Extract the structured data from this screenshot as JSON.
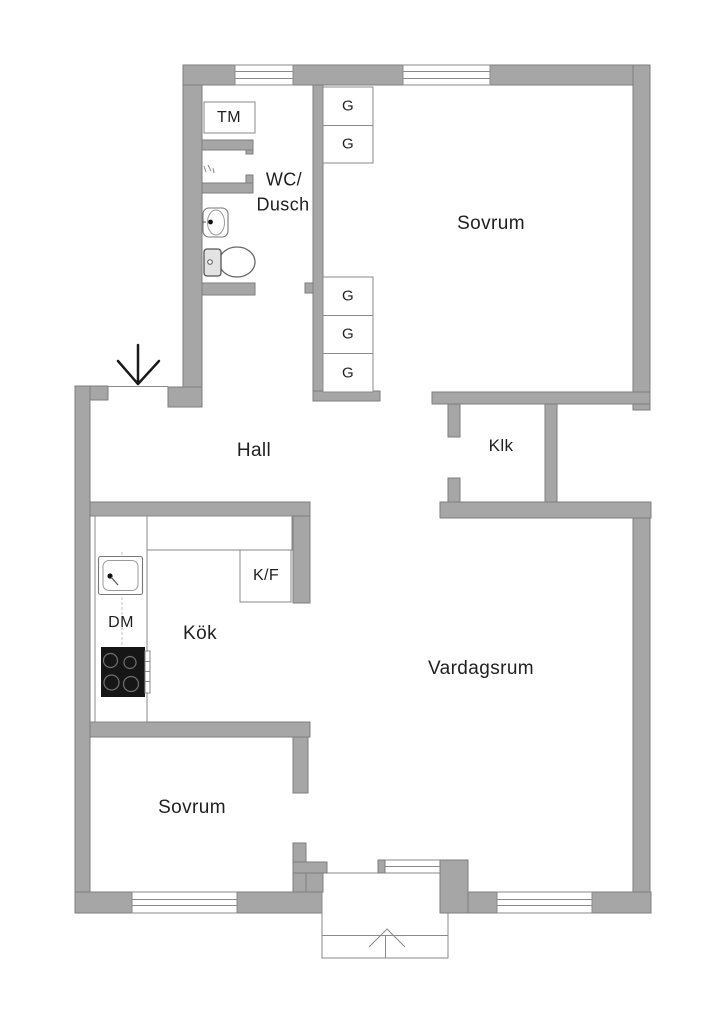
{
  "colors": {
    "background": "#ffffff",
    "wall": "#a6a6a6",
    "wall_outline": "#7e7e7e",
    "fixture_line": "#8a8a8a",
    "text": "#1f1f1f",
    "stove": "#161616"
  },
  "rooms": {
    "sovrum_top": "Sovrum",
    "hall": "Hall",
    "klk": "Klk",
    "kok": "Kök",
    "vardagsrum": "Vardagsrum",
    "sovrum_bottom": "Sovrum",
    "wc_dusch_line1": "WC/",
    "wc_dusch_line2": "Dusch"
  },
  "fixtures": {
    "washing_machine": "TM",
    "dishwasher": "DM",
    "fridge_freezer": "K/F",
    "wardrobe": "G"
  }
}
